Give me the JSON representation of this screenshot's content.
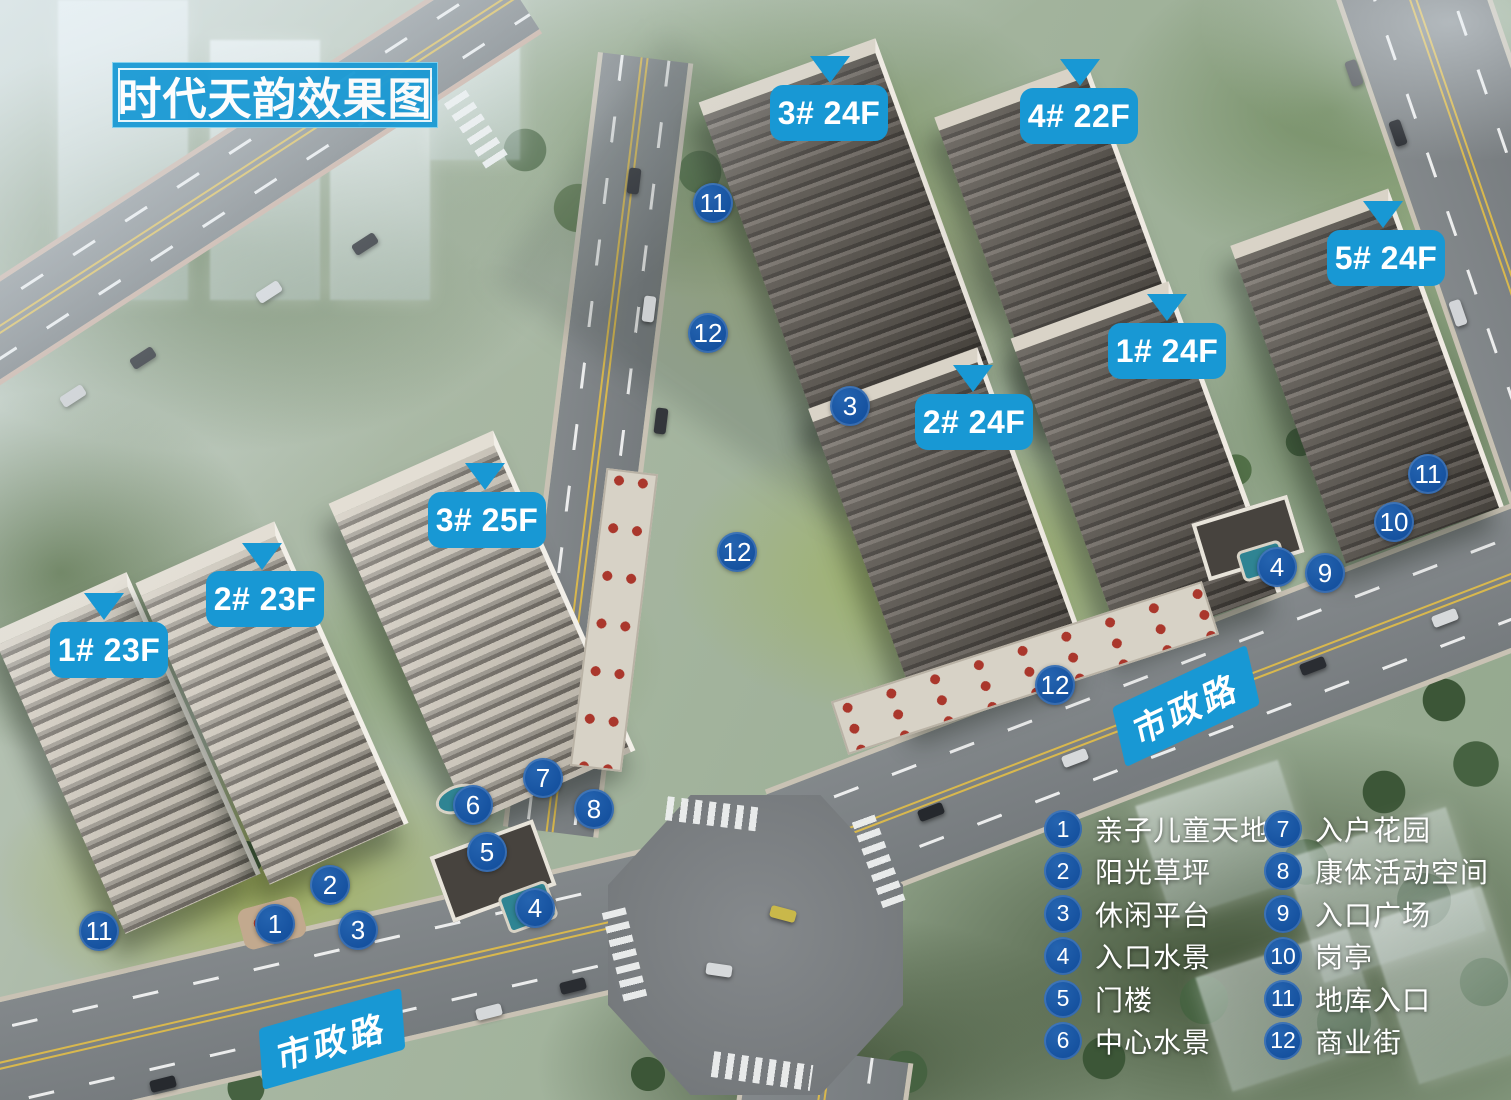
{
  "title": "时代天韵效果图",
  "colors": {
    "title_blue": "#1a9ad5",
    "label_blue": "#1898d4",
    "marker_blue": "#14509e"
  },
  "building_labels": [
    {
      "text": "3# 24F",
      "x": 770,
      "y": 85
    },
    {
      "text": "4# 22F",
      "x": 1020,
      "y": 88
    },
    {
      "text": "5# 24F",
      "x": 1327,
      "y": 230
    },
    {
      "text": "1# 24F",
      "x": 1108,
      "y": 323
    },
    {
      "text": "2# 24F",
      "x": 915,
      "y": 394
    },
    {
      "text": "3# 25F",
      "x": 428,
      "y": 492
    },
    {
      "text": "2# 23F",
      "x": 206,
      "y": 571
    },
    {
      "text": "1# 23F",
      "x": 50,
      "y": 622
    }
  ],
  "pointers": [
    {
      "x": 810,
      "y": 56
    },
    {
      "x": 1060,
      "y": 59
    },
    {
      "x": 1363,
      "y": 201
    },
    {
      "x": 1147,
      "y": 294
    },
    {
      "x": 953,
      "y": 365
    },
    {
      "x": 465,
      "y": 463
    },
    {
      "x": 242,
      "y": 543
    },
    {
      "x": 84,
      "y": 593
    }
  ],
  "map_markers": [
    {
      "num": "11",
      "x": 713,
      "y": 203
    },
    {
      "num": "12",
      "x": 708,
      "y": 333
    },
    {
      "num": "3",
      "x": 850,
      "y": 406
    },
    {
      "num": "12",
      "x": 737,
      "y": 552
    },
    {
      "num": "12",
      "x": 1055,
      "y": 685
    },
    {
      "num": "11",
      "x": 1428,
      "y": 474
    },
    {
      "num": "10",
      "x": 1394,
      "y": 522
    },
    {
      "num": "4",
      "x": 1277,
      "y": 567
    },
    {
      "num": "9",
      "x": 1325,
      "y": 573
    },
    {
      "num": "7",
      "x": 543,
      "y": 778
    },
    {
      "num": "6",
      "x": 473,
      "y": 805
    },
    {
      "num": "8",
      "x": 594,
      "y": 809
    },
    {
      "num": "5",
      "x": 487,
      "y": 852
    },
    {
      "num": "2",
      "x": 330,
      "y": 885
    },
    {
      "num": "4",
      "x": 535,
      "y": 908
    },
    {
      "num": "1",
      "x": 275,
      "y": 924
    },
    {
      "num": "3",
      "x": 358,
      "y": 930
    },
    {
      "num": "11",
      "x": 99,
      "y": 931
    }
  ],
  "road_labels": [
    {
      "text": "市政路",
      "x": 258,
      "y": 1009,
      "rotation": -16
    },
    {
      "text": "市政路",
      "x": 1112,
      "y": 676,
      "rotation": -25
    }
  ],
  "legend": {
    "column1": [
      {
        "num": "1",
        "label": "亲子儿童天地"
      },
      {
        "num": "2",
        "label": "阳光草坪"
      },
      {
        "num": "3",
        "label": "休闲平台"
      },
      {
        "num": "4",
        "label": "入口水景"
      },
      {
        "num": "5",
        "label": "门楼"
      },
      {
        "num": "6",
        "label": "中心水景"
      }
    ],
    "column2": [
      {
        "num": "7",
        "label": "入户花园"
      },
      {
        "num": "8",
        "label": "康体活动空间"
      },
      {
        "num": "9",
        "label": "入口广场"
      },
      {
        "num": "10",
        "label": "岗亭"
      },
      {
        "num": "11",
        "label": "地库入口"
      },
      {
        "num": "12",
        "label": "商业街"
      }
    ]
  }
}
